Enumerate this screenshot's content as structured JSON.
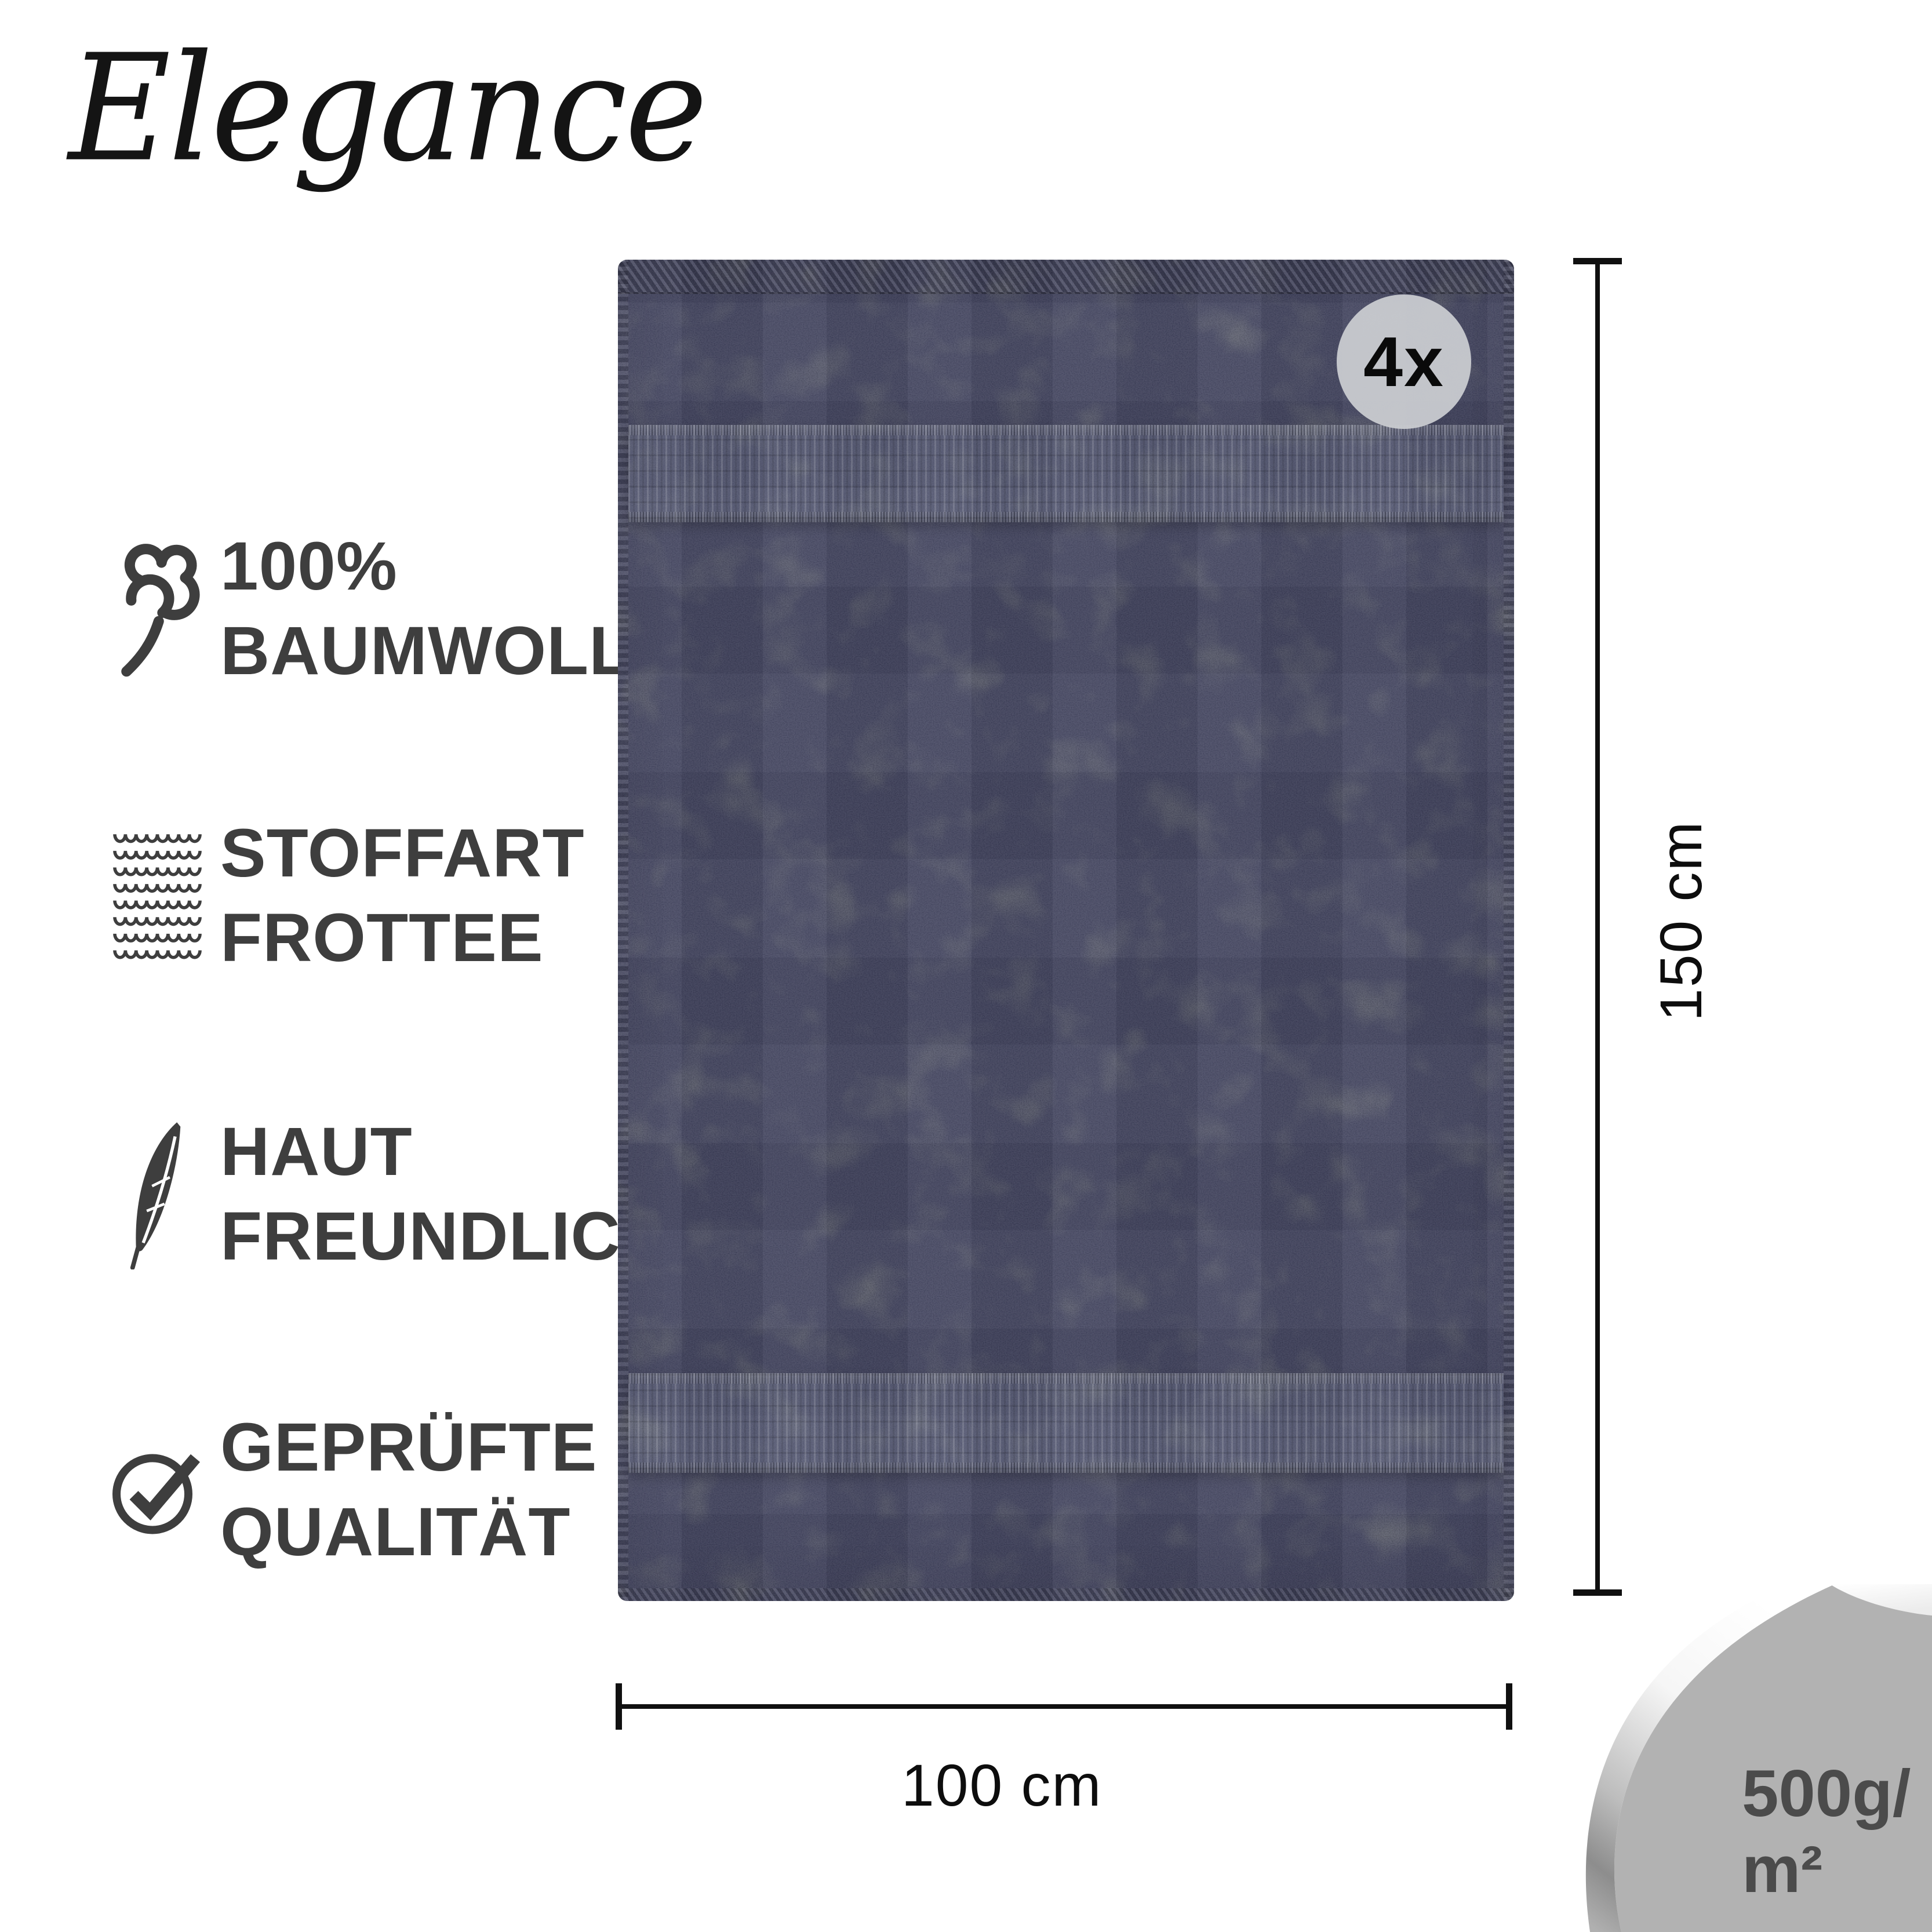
{
  "brand": {
    "logo_text": "Elegance"
  },
  "features": [
    {
      "icon": "cotton-icon",
      "lines": [
        "100%",
        "BAUMWOLLE"
      ]
    },
    {
      "icon": "fabric-texture-icon",
      "lines": [
        "STOFFART",
        "FROTTEE"
      ]
    },
    {
      "icon": "feather-icon",
      "lines": [
        "HAUT",
        "FREUNDLICH"
      ]
    },
    {
      "icon": "check-circle-icon",
      "lines": [
        "GEPRÜFTE",
        "QUALITÄT"
      ]
    }
  ],
  "product": {
    "quantity_badge": "4x",
    "height_label": "150 cm",
    "width_label": "100 cm",
    "weight_line1": "500g/",
    "weight_line2": "m²"
  },
  "colors": {
    "towel_base": "#4e515c",
    "towel_band": "#5d6170",
    "feature_text": "#3e3e3e",
    "badge_background": "#c9cbd0",
    "dimension_lines": "#101010",
    "corner_background": "#b2b2b2",
    "weight_text": "#4b4b4b",
    "page_background": "#ffffff"
  }
}
